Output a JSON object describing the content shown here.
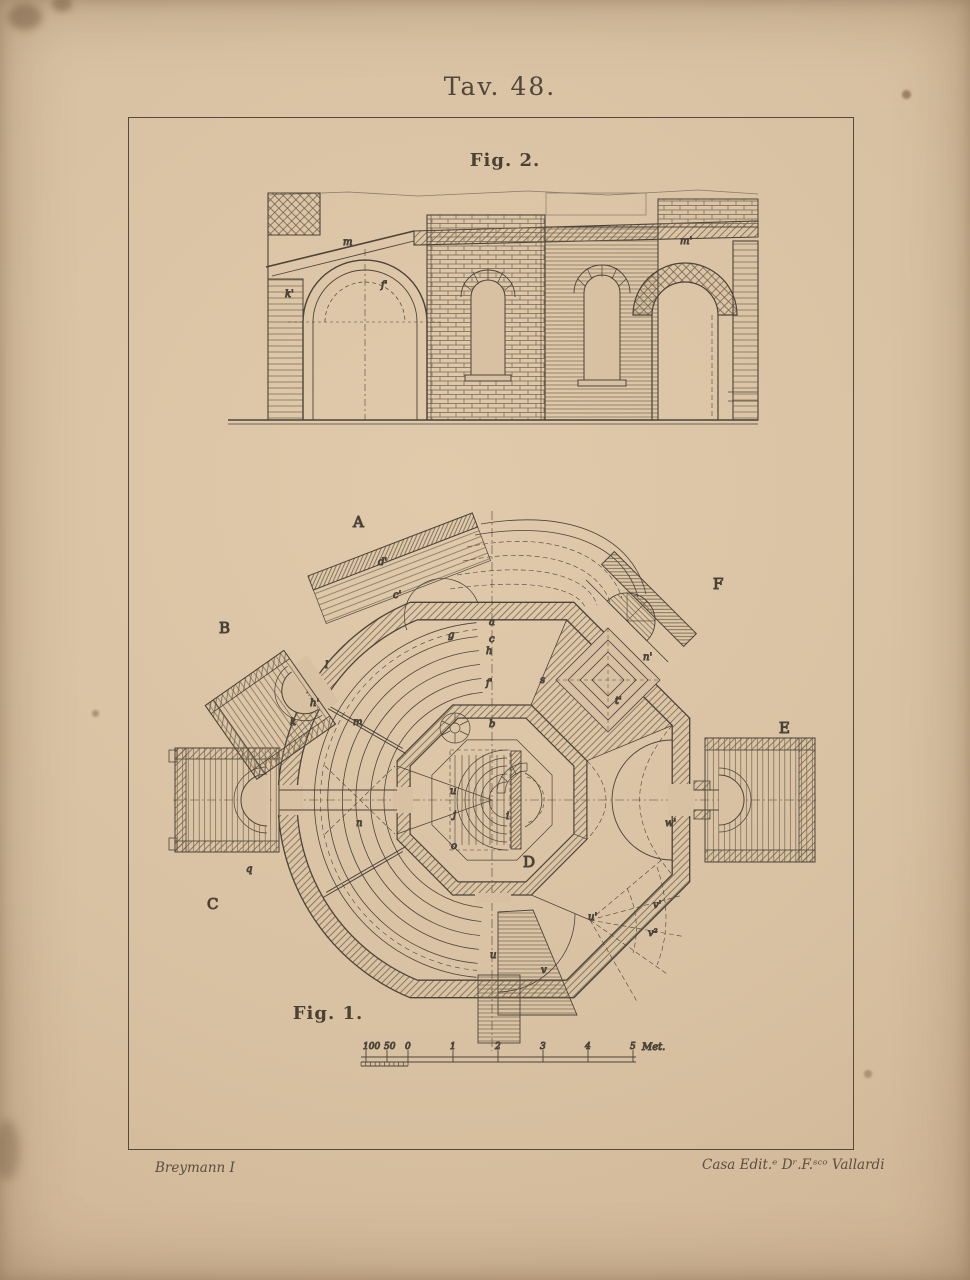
{
  "plate": {
    "title": "Tav. 48."
  },
  "fig2": {
    "label": "Fig. 2.",
    "letters": [
      {
        "t": "m",
        "x": 115,
        "y": 58
      },
      {
        "t": "k'",
        "x": 57,
        "y": 110
      },
      {
        "t": "f'",
        "x": 153,
        "y": 101
      },
      {
        "t": "m'",
        "x": 452,
        "y": 57
      }
    ]
  },
  "fig1": {
    "label": "Fig. 1.",
    "letters_large": [
      {
        "t": "A",
        "x": 208,
        "y": 32
      },
      {
        "t": "B",
        "x": 74,
        "y": 138
      },
      {
        "t": "C",
        "x": 62,
        "y": 414
      },
      {
        "t": "D",
        "x": 378,
        "y": 372
      },
      {
        "t": "E",
        "x": 634,
        "y": 238
      },
      {
        "t": "F",
        "x": 568,
        "y": 94
      }
    ],
    "letters_small": [
      {
        "t": "d'",
        "x": 233,
        "y": 70
      },
      {
        "t": "c'",
        "x": 248,
        "y": 103
      },
      {
        "t": "g",
        "x": 303,
        "y": 143
      },
      {
        "t": "a",
        "x": 344,
        "y": 130
      },
      {
        "t": "c",
        "x": 344,
        "y": 147
      },
      {
        "t": "h",
        "x": 341,
        "y": 159
      },
      {
        "t": "f'",
        "x": 341,
        "y": 191
      },
      {
        "t": "s",
        "x": 395,
        "y": 188
      },
      {
        "t": "b",
        "x": 344,
        "y": 232
      },
      {
        "t": "l",
        "x": 180,
        "y": 173
      },
      {
        "t": "h'",
        "x": 165,
        "y": 211
      },
      {
        "t": "k",
        "x": 145,
        "y": 230
      },
      {
        "t": "m",
        "x": 208,
        "y": 230
      },
      {
        "t": "n",
        "x": 211,
        "y": 331
      },
      {
        "t": "q",
        "x": 101,
        "y": 377
      },
      {
        "t": "u",
        "x": 305,
        "y": 299
      },
      {
        "t": "j",
        "x": 308,
        "y": 323
      },
      {
        "t": "o",
        "x": 306,
        "y": 354
      },
      {
        "t": "i",
        "x": 361,
        "y": 324
      },
      {
        "t": "n'",
        "x": 498,
        "y": 165
      },
      {
        "t": "t'",
        "x": 470,
        "y": 209
      },
      {
        "t": "w'",
        "x": 520,
        "y": 331
      },
      {
        "t": "u'",
        "x": 443,
        "y": 425
      },
      {
        "t": "v'",
        "x": 508,
        "y": 413
      },
      {
        "t": "v²",
        "x": 503,
        "y": 441
      },
      {
        "t": "u",
        "x": 345,
        "y": 463
      },
      {
        "t": "v",
        "x": 396,
        "y": 478
      }
    ]
  },
  "scale": {
    "ticks": [
      {
        "label": "100",
        "x": 10
      },
      {
        "label": "50",
        "x": 31
      },
      {
        "label": "0",
        "x": 52
      },
      {
        "label": "1",
        "x": 97
      },
      {
        "label": "2",
        "x": 142
      },
      {
        "label": "3",
        "x": 187
      },
      {
        "label": "4",
        "x": 232
      },
      {
        "label": "5",
        "x": 277
      }
    ],
    "unit": "Met.",
    "unit_x": 286
  },
  "credits": {
    "left": "Breymann I",
    "right": "Casa Edit.ᵉ Dʳ.F.ˢᶜᵒ Vallardi"
  },
  "colors": {
    "paper": "#d8c1a2",
    "ink": "#4c4339",
    "hatch": "#74654f"
  }
}
